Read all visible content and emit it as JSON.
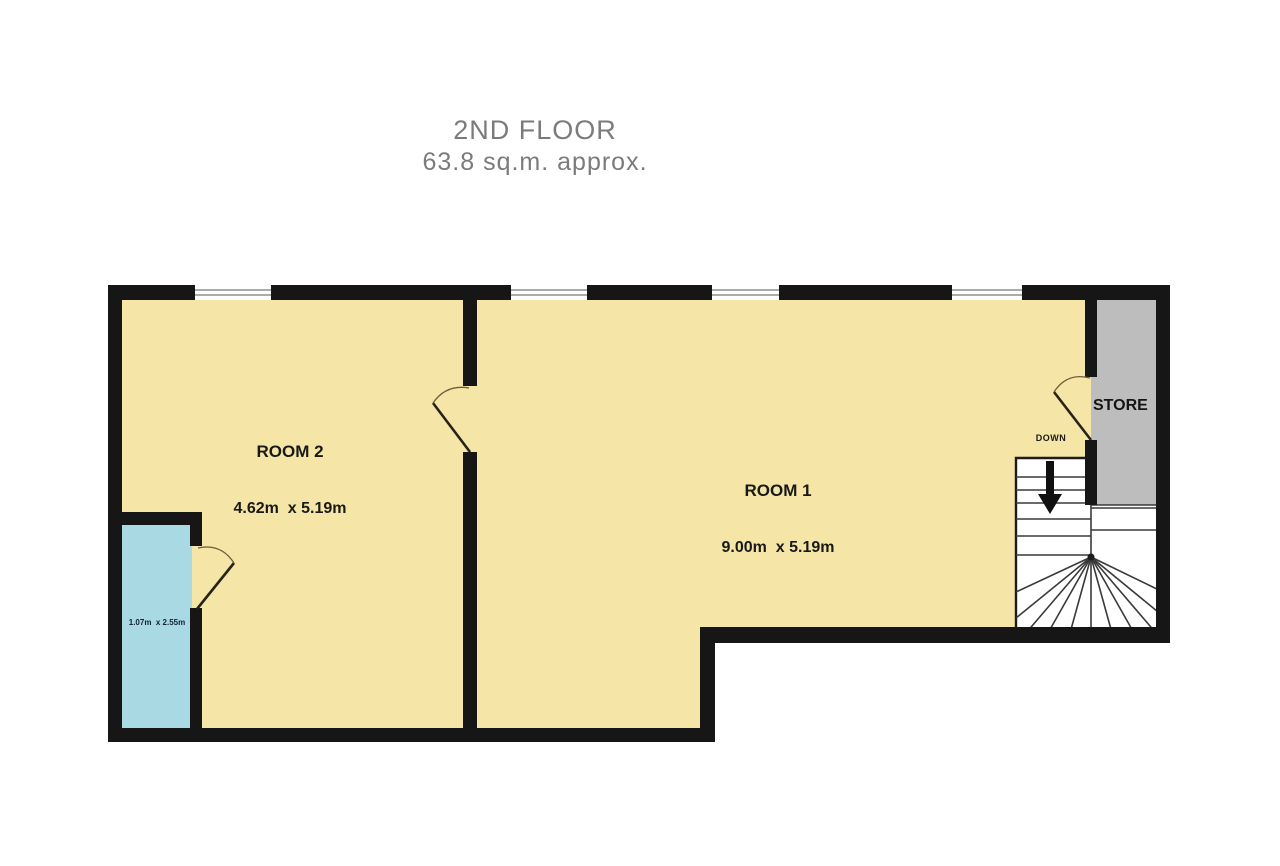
{
  "title": {
    "line1": "2ND FLOOR",
    "line2": "63.8 sq.m. approx."
  },
  "floor_plan": {
    "room1": {
      "name": "ROOM 1",
      "dimensions": "9.00m  x 5.19m"
    },
    "room2": {
      "name": "ROOM 2",
      "dimensions": "4.62m  x 5.19m"
    },
    "store": {
      "name": "STORE"
    },
    "wet_room": {
      "dimensions": "1.07m  x 2.55m"
    },
    "stairs": {
      "direction_label": "DOWN"
    },
    "colors": {
      "floor": "#f5e5a6",
      "wet_room": "#a9d9e3",
      "store": "#bdbdbd",
      "wall": "#161616",
      "stair_fill": "#ffffff",
      "title_text": "#7b7b7b"
    }
  }
}
